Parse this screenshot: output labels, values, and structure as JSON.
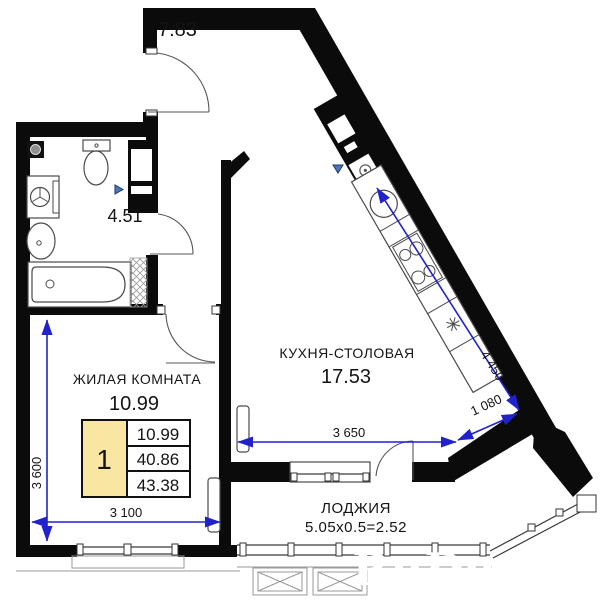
{
  "rooms": {
    "hallway": {
      "area": "7.83"
    },
    "bathroom": {
      "area": "4.51"
    },
    "living": {
      "name": "ЖИЛАЯ КОМНАТА",
      "area": "10.99"
    },
    "kitchen": {
      "name": "КУХНЯ-СТОЛОВАЯ",
      "area": "17.53"
    },
    "loggia": {
      "name": "ЛОДЖИЯ",
      "calc": "5.05x0.5=2.52"
    }
  },
  "summary_table": {
    "rooms_count": "1",
    "living_area": "10.99",
    "area_without_loggia": "40.86",
    "total_area": "43.38"
  },
  "dimensions": {
    "living_width_mm": "3 100",
    "living_depth_mm": "3 600",
    "kitchen_width_mm": "3 650",
    "kitchen_diag_wall_mm": "4 450",
    "corner_wall_mm": "1 080"
  },
  "watermark": "RuDos.ru",
  "colors": {
    "wall": "#0b0b0b",
    "dimension_blue": "#2222cc",
    "table_highlight": "#f9e6a3",
    "watermark_gray": "#8a8a8a"
  }
}
